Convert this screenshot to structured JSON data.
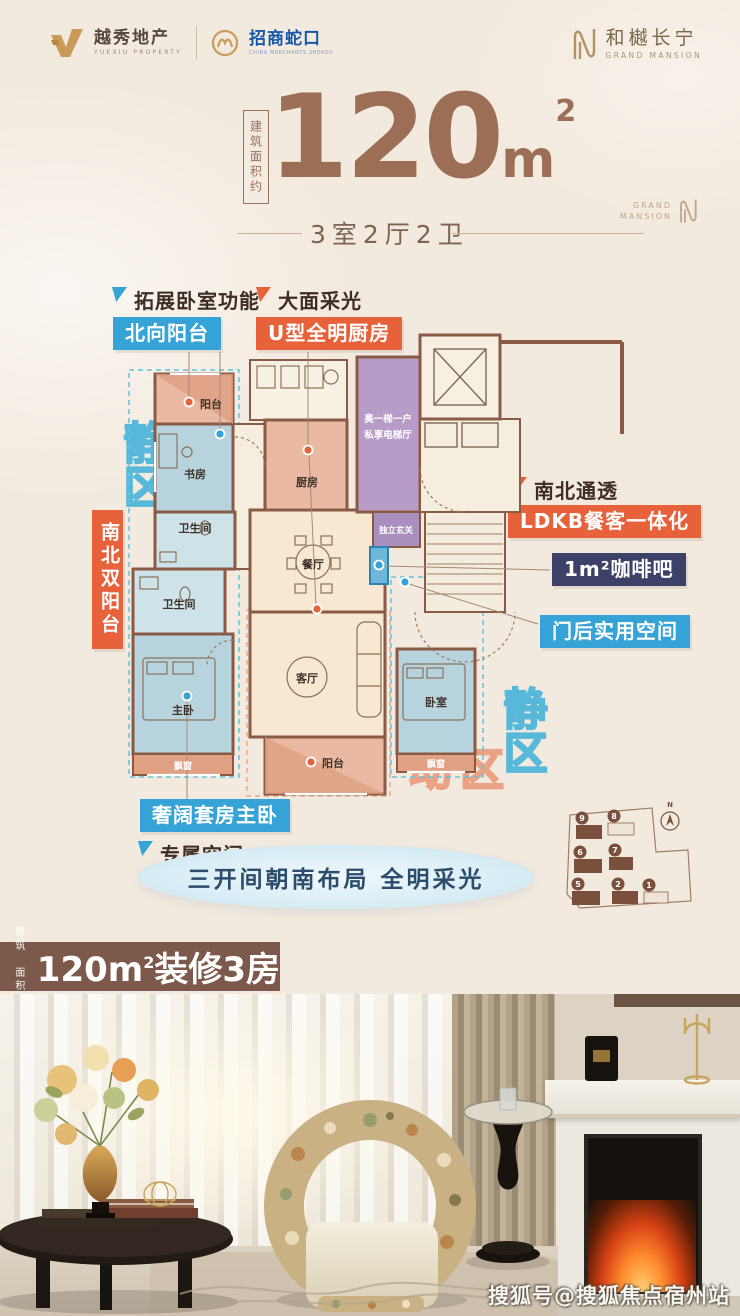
{
  "header": {
    "yuexiu": {
      "cn": "越秀地产",
      "en": "YUEXIU PROPERTY"
    },
    "shekou": {
      "cn": "招商蛇口",
      "en": "CHINA MERCHANTS SHEKOU"
    },
    "project": {
      "cn": "和樾长宁",
      "en": "GRAND MANSION"
    }
  },
  "title": {
    "area_label": "建筑面积约",
    "value": "120",
    "unit": "m",
    "sup": "2",
    "subtitle": "3室2厅2卫",
    "watermark_top": "GRAND",
    "watermark_bottom": "MANSION"
  },
  "callouts": {
    "c1_title": "拓展卧室功能",
    "c1_tag": "北向阳台",
    "c2_title": "大面采光",
    "c2_tag": "U型全明厨房",
    "c3_title": "南北通透",
    "c3_tag": "LDKB餐客一体化",
    "c4_tag": "1m²咖啡吧",
    "c5_tag": "门后实用空间",
    "c6_tag": "奢阔套房主卧",
    "c6_title": "专属空间",
    "side_tag": "南北双阳台",
    "quiet_left": "静区",
    "quiet_right": "静区",
    "active": "动区"
  },
  "floorplan": {
    "balcony_n": "阳台",
    "study": "书房",
    "bath1": "卫生间",
    "bath2": "卫生间",
    "master": "主卧",
    "bay1": "飘窗",
    "kitchen": "厨房",
    "dining": "餐厅",
    "living": "客厅",
    "balcony_s": "阳台",
    "bedroom": "卧室",
    "bay2": "飘窗",
    "foyer": "独立玄关",
    "hall_l1": "奥一梯一户",
    "hall_l2": "私享电梯厅"
  },
  "slogan": "三开间朝南布局 全明采光",
  "siteplan": {
    "compass": "N",
    "buildings": [
      "9",
      "8",
      "6",
      "7",
      "5",
      "2",
      "1"
    ]
  },
  "banner": {
    "prefix_top": "建 筑",
    "prefix_bottom": "面积约",
    "main": "120m",
    "sup": "2",
    "suffix": "装修3房"
  },
  "photo": {
    "watermark": "搜狐号@搜狐焦点宿州站"
  }
}
